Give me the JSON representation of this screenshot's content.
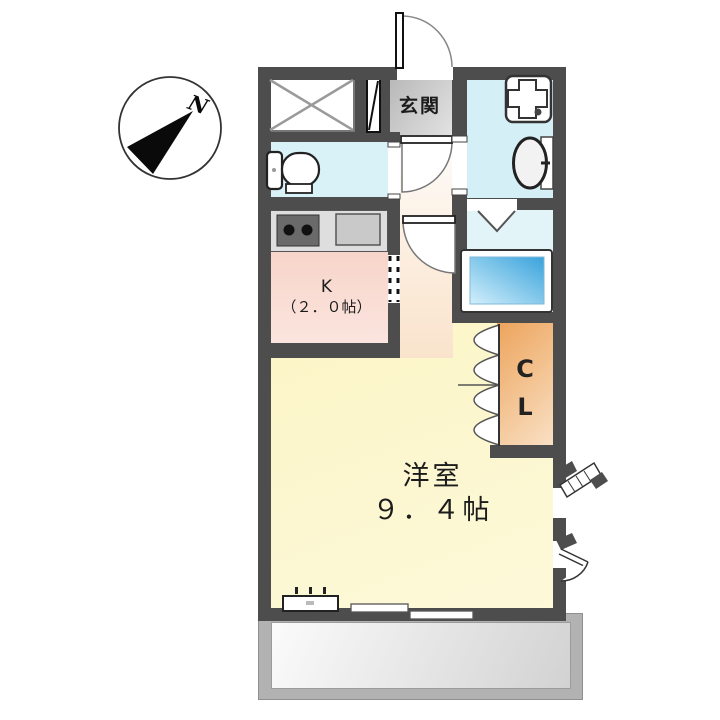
{
  "compass": {
    "north_label": "N"
  },
  "entrance": {
    "label": "玄関"
  },
  "kitchen": {
    "label": "K",
    "size_label": "（２．０帖）"
  },
  "main_room": {
    "label": "洋室",
    "size_label": "９．４帖"
  },
  "closet": {
    "label_line1": "C",
    "label_line2": "L"
  },
  "colors": {
    "wall": "#4d4d4d",
    "toilet-room": "#d9f2f7",
    "washroom": "#d5eff6",
    "bathroom": "#e3f4f9",
    "kitchen-top": "#f6cdc0",
    "kitchen-bottom": "#fbe5de",
    "hall": "#f9e3cc",
    "main-room-top": "#faf2ba",
    "main-room-bottom": "#fdf9d9",
    "closet-top": "#eda45c",
    "closet-bottom": "#f9e0c4",
    "genkan-dark": "#b8b8b8",
    "genkan-light": "#e2e2e2",
    "tub-dark": "#39a3dc",
    "tub-light": "#d3effb",
    "balcony-frame": "#b2b2b2",
    "balcony-inner-light": "#fbfbfb",
    "balcony-inner-dark": "#d2d2d2"
  }
}
